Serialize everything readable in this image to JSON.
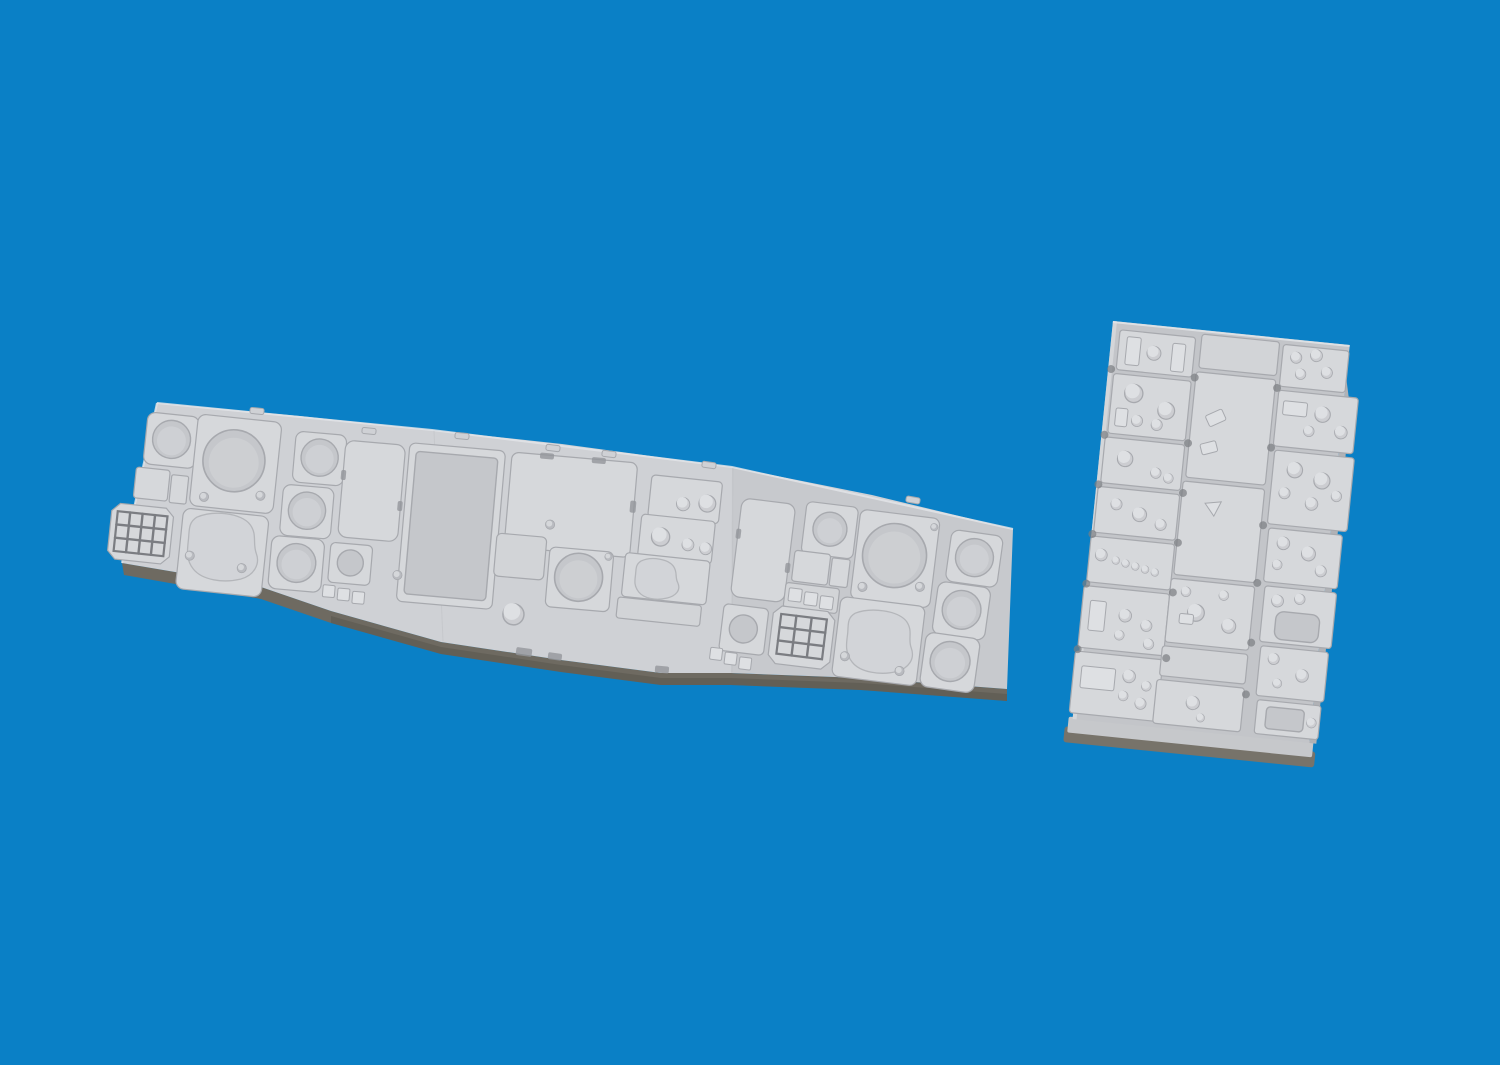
{
  "image": {
    "alt": "Two grey resin model-kit cockpit panel parts rendered on a plain blue background",
    "background_style": "solid blue studio backdrop"
  },
  "parts": [
    {
      "id": "main-instrument-panel",
      "description": "Long segmented cockpit instrument panel with round gauge bezels, CRT screens, display frames, keypads and switch clusters",
      "features": [
        "round gauges",
        "keypad 4x3",
        "keypad 3x3",
        "CRT squares with screws",
        "MFD frame",
        "knob clusters",
        "three right-hand gauge bezels"
      ]
    },
    {
      "id": "side-console-panel",
      "description": "Rectangular avionics console block with three columns of raised sub-panels fitted with cylindrical knobs, stubs and recesses",
      "features": [
        "three sub-panel columns",
        "cylindrical knobs",
        "scalloped groove notches",
        "triangle marking",
        "thick pour base"
      ]
    }
  ],
  "colors": {
    "bg": "#0a80c6",
    "face": "#cfd1d5",
    "plate": "#c3c5c9",
    "raised": "#d6d8db",
    "raised2": "#d2d4d7",
    "recess": "#c5c7cb",
    "dial": "#ced0d4",
    "screen": "#d2d4d8",
    "blobrim": "#b4b6ba",
    "rim": "#a7a9ae",
    "groove": "#94969b",
    "groove_dark": "#7b7d82",
    "knob": "#cccdd1",
    "knob_hi": "#dee0e3",
    "screw": "#b9bbc0",
    "screw_hi": "#d5d7da",
    "side": "#b0b2b6",
    "side_light": "#d9dbde",
    "shadow": "#6e6a61",
    "shadow_dark": "#59564f",
    "base": "#c6c8cb",
    "base_shadow": "#77736a",
    "highlight": "#e2e4e7"
  }
}
